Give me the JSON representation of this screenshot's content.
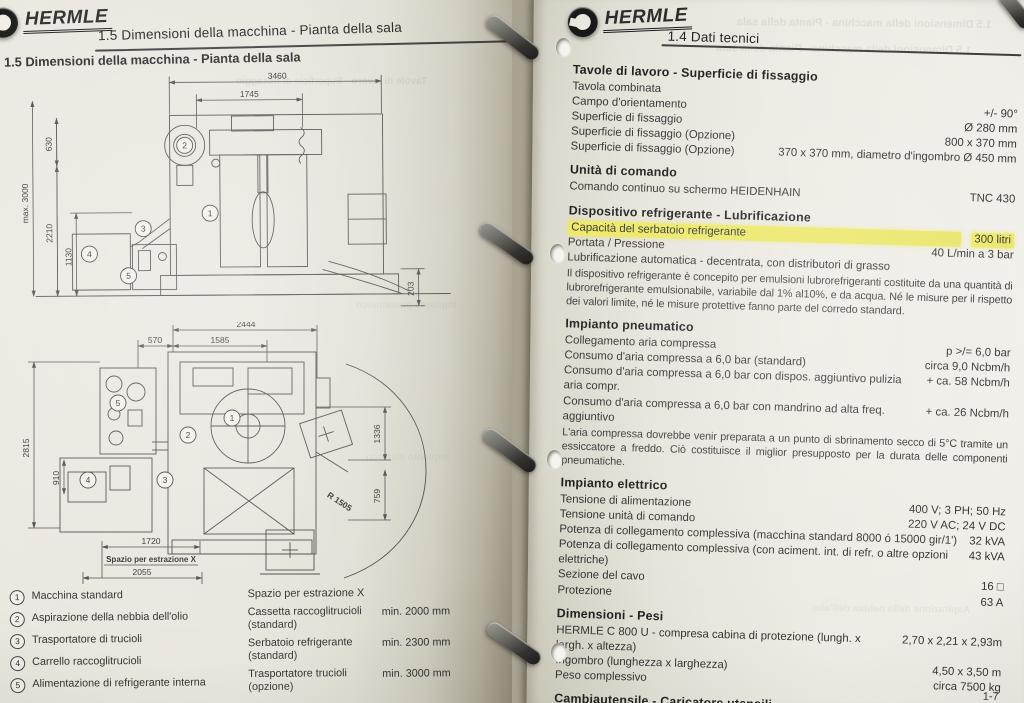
{
  "colors": {
    "highlight": "#ede861",
    "paper": "#ebe8e0",
    "backdrop": "#a8a291",
    "ink": "#2b2b2b",
    "line_art": "#4a4a4a"
  },
  "left_page": {
    "logo_text": "HERMLE",
    "header_title": "1.5 Dimensioni della macchina - Pianta della sala",
    "section_title": "1.5 Dimensioni della macchina - Pianta della sala",
    "drawing_top": {
      "dims": {
        "w3460": "3460",
        "w1745": "1745",
        "h630": "630",
        "hmax": "max. 3000",
        "h2210": "2210",
        "h1130": "1130",
        "h203": "203"
      }
    },
    "drawing_bottom": {
      "dims": {
        "w2444": "2444",
        "w570": "570",
        "w1585": "1585",
        "h2815": "2815",
        "h910": "910",
        "h1336": "1336",
        "h759": "759",
        "r1505": "R 1505",
        "w1720": "1720",
        "label_extraction": "Spazio  per  estrazione  X",
        "w2055": "2055"
      }
    },
    "callout_numbers": [
      "1",
      "2",
      "3",
      "4",
      "5"
    ],
    "legend": [
      {
        "num": "1",
        "label": "Macchina standard"
      },
      {
        "num": "2",
        "label": "Aspirazione della nebbia dell'olio"
      },
      {
        "num": "3",
        "label": "Trasportatore di trucioli"
      },
      {
        "num": "4",
        "label": "Carrello raccoglitrucioli"
      },
      {
        "num": "5",
        "label": "Alimentazione di refrigerante interna"
      }
    ],
    "extraction_space": {
      "title": "Spazio per estrazione X",
      "rows": [
        {
          "label": "Cassetta raccoglitrucioli",
          "sub": "(standard)",
          "value": "min. 2000 mm"
        },
        {
          "label": "Serbatoio refrigerante",
          "sub": "(standard)",
          "value": "min. 2300 mm"
        },
        {
          "label": "Trasportatore trucioli",
          "sub": "(opzione)",
          "value": "min. 3000 mm"
        }
      ]
    }
  },
  "right_page": {
    "logo_text": "HERMLE",
    "header_title": "1.4 Dati tecnici",
    "page_number": "1-7",
    "sections": [
      {
        "heading": "Tavole di lavoro - Superficie di fissaggio",
        "rows": [
          {
            "label": "Tavola combinata",
            "value": ""
          },
          {
            "label": "Campo d'orientamento",
            "value": "+/- 90°"
          },
          {
            "label": "Superficie di fissaggio",
            "value": "Ø 280 mm"
          },
          {
            "label": "Superficie di fissaggio  (Opzione)",
            "value": "800 x 370 mm"
          },
          {
            "label": "Superficie di fissaggio  (Opzione)",
            "value": "370 x 370 mm,  diametro d'ingombro Ø 450 mm"
          }
        ]
      },
      {
        "heading": "Unità di comando",
        "rows": [
          {
            "label": "Comando continuo su schermo HEIDENHAIN",
            "value": "TNC 430"
          }
        ]
      },
      {
        "heading": "Dispositivo refrigerante - Lubrificazione",
        "rows": [
          {
            "label": "Capacità del serbatoio refrigerante",
            "value": "300 litri",
            "hl": true
          },
          {
            "label": "Portata / Pressione",
            "value": "40 L/min a 3 bar"
          },
          {
            "label": "Lubrificazione automatica - decentrata, con distributori di grasso",
            "value": ""
          }
        ],
        "note": "Il dispositivo refrigerante è concepito per emulsioni lubrorefrigeranti costituite da una quantità di lubrorefrigerante emulsionabile, variabile dal 1% al10%, e da acqua. Né le misure per il rispetto dei valori limite, né le misure protettive fanno parte del corredo standard."
      },
      {
        "heading": "Impianto pneumatico",
        "rows": [
          {
            "label": "Collegamento aria compressa",
            "value": "p >/= 6,0 bar"
          },
          {
            "label": "Consumo d'aria compressa a  6,0 bar (standard)",
            "value": "circa 9,0 Ncbm/h"
          },
          {
            "label": "Consumo d'aria compressa a  6,0 bar con dispos. aggiuntivo pulizia aria compr.",
            "value": "+ ca. 58 Ncbm/h"
          },
          {
            "label": "Consumo d'aria compressa a  6,0 bar con mandrino ad alta freq. aggiuntivo",
            "value": "+ ca. 26 Ncbm/h"
          }
        ],
        "note": "L'aria compressa dovrebbe venir preparata a un punto di sbrinamento secco di 5°C tramite un essiccatore a freddo. Ciò costituisce il miglior presupposto per la durata delle componenti pneumatiche."
      },
      {
        "heading": "Impianto elettrico",
        "rows": [
          {
            "label": "Tensione di alimentazione",
            "value": "400 V; 3 PH; 50 Hz"
          },
          {
            "label": "Tensione unità di comando",
            "value": "220 V AC; 24 V DC"
          },
          {
            "label": "Potenza di collegamento complessiva (macchina standard 8000 ó 15000 gir/1')",
            "value": "32 kVA"
          },
          {
            "label": "Potenza di collegamento complessiva (con aciment. int. di refr. o altre opzioni elettriche)",
            "value": "43 kVA"
          },
          {
            "label": "Sezione del cavo",
            "value": "16  □"
          },
          {
            "label": "Protezione",
            "value": "63 A"
          }
        ]
      },
      {
        "heading": "Dimensioni - Pesi",
        "rows": [
          {
            "label": "HERMLE C 800 U - compresa cabina di protezione (lungh. x largh. x altezza)",
            "value": "2,70 x 2,21 x 2,93m"
          },
          {
            "label": "Ingombro (lunghezza x larghezza)",
            "value": "4,50 x 3,50 m"
          },
          {
            "label": "Peso complessivo",
            "value": "circa 7500 kg"
          }
        ]
      },
      {
        "heading": "Cambiautensile - Caricatore utensili",
        "rows": [
          {
            "label": "Cambiautensile Pick-Up con 30 posti utensile nel caricatore ad anello",
            "value": ""
          }
        ]
      }
    ]
  }
}
